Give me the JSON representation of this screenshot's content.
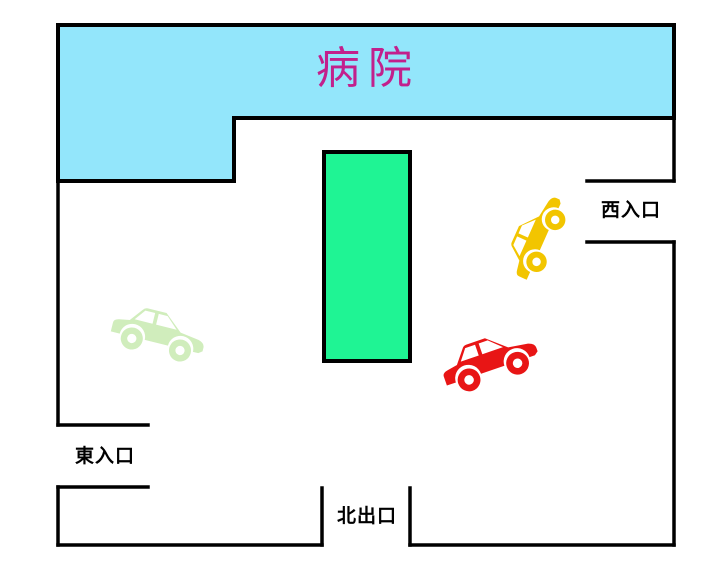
{
  "hospital": {
    "label": "病院"
  },
  "labels": {
    "west_entrance": "西入口",
    "east_entrance": "東入口",
    "north_exit": "北出口"
  },
  "cars": [
    {
      "name": "yellow-car",
      "color": "#F2C500"
    },
    {
      "name": "red-car",
      "color": "#E81515"
    },
    {
      "name": "green-car",
      "color": "#D0EDBC"
    }
  ],
  "colors": {
    "hospital_fill": "#93E6FB",
    "hospital_label_text": "#C2208C",
    "island_fill": "#1FF494",
    "wall": "#000000",
    "background": "#FFFFFF"
  }
}
